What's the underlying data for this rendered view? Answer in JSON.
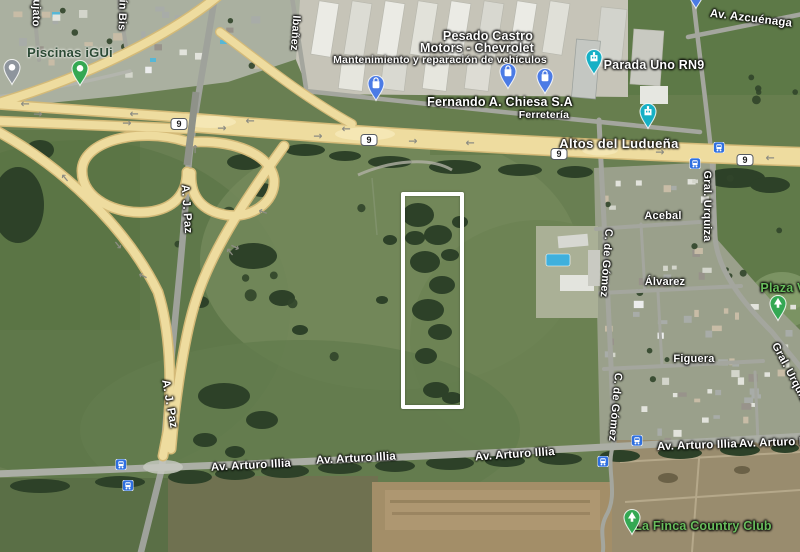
{
  "map": {
    "colors": {
      "pin_blue": "#4b7be5",
      "pin_teal": "#16b0c5",
      "pin_gray": "#8e959d",
      "pin_green": "#34a853",
      "transit_blue": "#2e6fe0",
      "highway_yellow": "#eedc9f",
      "poi_green_text": "#68bd5c",
      "poi_darkgreen_text": "#2c4a35",
      "highlight_stroke": "#ffffff"
    },
    "highlight": {
      "x": 401,
      "y": 192,
      "width": 63,
      "height": 217,
      "stroke_width": 4.5
    },
    "route_shields": [
      {
        "label": "9",
        "x": 179,
        "y": 124
      },
      {
        "label": "9",
        "x": 369,
        "y": 140
      },
      {
        "label": "9",
        "x": 559,
        "y": 154
      },
      {
        "label": "9",
        "x": 745,
        "y": 160
      }
    ],
    "street_labels": [
      {
        "text": "ujato",
        "x": 36,
        "y": 13,
        "rot": 92
      },
      {
        "text": "ín Bis",
        "x": 122,
        "y": 15,
        "rot": 92
      },
      {
        "text": "Ibañez",
        "x": 295,
        "y": 33,
        "rot": 94
      },
      {
        "text": "A. J. Paz",
        "x": 186,
        "y": 209,
        "rot": 86,
        "size": 11.5
      },
      {
        "text": "A. J. Paz",
        "x": 169,
        "y": 404,
        "rot": 80,
        "size": 11.5
      },
      {
        "text": "Av. Azcuénaga",
        "x": 751,
        "y": 19,
        "rot": 7,
        "size": 11.5
      },
      {
        "text": "Acebal",
        "x": 663,
        "y": 216,
        "rot": 0
      },
      {
        "text": "Gral. Urquiza",
        "x": 707,
        "y": 206,
        "rot": 90
      },
      {
        "text": "Álvarez",
        "x": 665,
        "y": 282,
        "rot": 0
      },
      {
        "text": "C. de Gómez",
        "x": 606,
        "y": 263,
        "rot": 94
      },
      {
        "text": "Figuera",
        "x": 694,
        "y": 359,
        "rot": 0
      },
      {
        "text": "Gral. Urquiza",
        "x": 791,
        "y": 375,
        "rot": 62
      },
      {
        "text": "C. de Gómez",
        "x": 615,
        "y": 407,
        "rot": 95
      },
      {
        "text": "Av. Arturo Illia",
        "x": 251,
        "y": 466,
        "rot": -3,
        "size": 11.5
      },
      {
        "text": "Av. Arturo Illia",
        "x": 356,
        "y": 459,
        "rot": -3,
        "size": 11.5
      },
      {
        "text": "Av. Arturo Illia",
        "x": 515,
        "y": 455,
        "rot": -4,
        "size": 11.5
      },
      {
        "text": "Av. Arturo Illia",
        "x": 697,
        "y": 446,
        "rot": -2,
        "size": 11.5
      },
      {
        "text": "Av. Arturo Illia",
        "x": 779,
        "y": 443,
        "rot": -2,
        "size": 11.5
      }
    ],
    "locality_label": {
      "text": "Altos del Ludueña",
      "x": 619,
      "y": 144
    },
    "poi_labels": [
      {
        "text": "Piscinas iGUi",
        "x": 70,
        "y": 53,
        "cls": "poi-darkgreen"
      },
      {
        "text": "Pesado Castro",
        "x": 488,
        "y": 37,
        "cls": "poi-title"
      },
      {
        "text": "Motors - Chevrolet",
        "x": 477,
        "y": 49,
        "cls": "poi-title"
      },
      {
        "text": "Mantenimiento y reparación de vehículos",
        "x": 440,
        "y": 61,
        "cls": "poi-sub"
      },
      {
        "text": "Fernando A. Chiesa S.A",
        "x": 500,
        "y": 103,
        "cls": "poi-title"
      },
      {
        "text": "Ferretería",
        "x": 544,
        "y": 116,
        "cls": "poi-sub"
      },
      {
        "text": "Parada Uno RN9",
        "x": 654,
        "y": 66,
        "cls": "poi-title"
      },
      {
        "text": "Plaza V",
        "x": 783,
        "y": 289,
        "cls": "poi-green"
      },
      {
        "text": "La Finca Country Club",
        "x": 703,
        "y": 527,
        "cls": "poi-green"
      }
    ],
    "pins": [
      {
        "glyph": "bag",
        "color_key": "pin_blue",
        "x": 376,
        "y": 86,
        "name": "shopping-pin"
      },
      {
        "glyph": "bag",
        "color_key": "pin_blue",
        "x": 508,
        "y": 74,
        "name": "shopping-pin"
      },
      {
        "glyph": "bag",
        "color_key": "pin_blue",
        "x": 545,
        "y": 79,
        "name": "shopping-pin"
      },
      {
        "glyph": "building",
        "color_key": "pin_teal",
        "x": 594,
        "y": 60,
        "name": "parada-uno-pin"
      },
      {
        "glyph": "building",
        "color_key": "pin_teal",
        "x": 648,
        "y": 114,
        "name": "altos-del-luduena-pin"
      },
      {
        "glyph": "bag",
        "color_key": "pin_blue",
        "x": 696,
        "y": -6,
        "name": "clipped-top-pin"
      },
      {
        "glyph": "dot",
        "color_key": "pin_gray",
        "x": 12,
        "y": 70,
        "name": "gray-place-pin"
      },
      {
        "glyph": "dot",
        "color_key": "pin_green",
        "x": 80,
        "y": 71,
        "name": "piscinas-igui-pin"
      },
      {
        "glyph": "tree",
        "color_key": "pin_green",
        "x": 778,
        "y": 306,
        "name": "plaza-park-pin"
      },
      {
        "glyph": "tree",
        "color_key": "pin_green",
        "x": 632,
        "y": 520,
        "name": "la-finca-park-pin"
      }
    ],
    "transit_stops": [
      {
        "x": 719,
        "y": 149
      },
      {
        "x": 695,
        "y": 165
      },
      {
        "x": 637,
        "y": 442
      },
      {
        "x": 603,
        "y": 463
      },
      {
        "x": 121,
        "y": 466
      },
      {
        "x": 128,
        "y": 487
      }
    ],
    "road_arrows": [
      {
        "x": 25,
        "y": 104,
        "a": 180
      },
      {
        "x": 38,
        "y": 114,
        "a": 0
      },
      {
        "x": 134,
        "y": 114,
        "a": 180
      },
      {
        "x": 127,
        "y": 123,
        "a": 0
      },
      {
        "x": 250,
        "y": 121,
        "a": 180
      },
      {
        "x": 222,
        "y": 128,
        "a": 0
      },
      {
        "x": 318,
        "y": 136,
        "a": 0
      },
      {
        "x": 346,
        "y": 129,
        "a": 180
      },
      {
        "x": 413,
        "y": 141,
        "a": 0
      },
      {
        "x": 470,
        "y": 143,
        "a": 180
      },
      {
        "x": 660,
        "y": 152,
        "a": 0
      },
      {
        "x": 770,
        "y": 158,
        "a": 180
      },
      {
        "x": 195,
        "y": 149,
        "a": 270
      },
      {
        "x": 65,
        "y": 178,
        "a": 230
      },
      {
        "x": 263,
        "y": 212,
        "a": 200
      },
      {
        "x": 235,
        "y": 247,
        "a": 25
      },
      {
        "x": 118,
        "y": 245,
        "a": 50
      },
      {
        "x": 230,
        "y": 252,
        "a": 230
      },
      {
        "x": 143,
        "y": 276,
        "a": 205
      }
    ]
  }
}
